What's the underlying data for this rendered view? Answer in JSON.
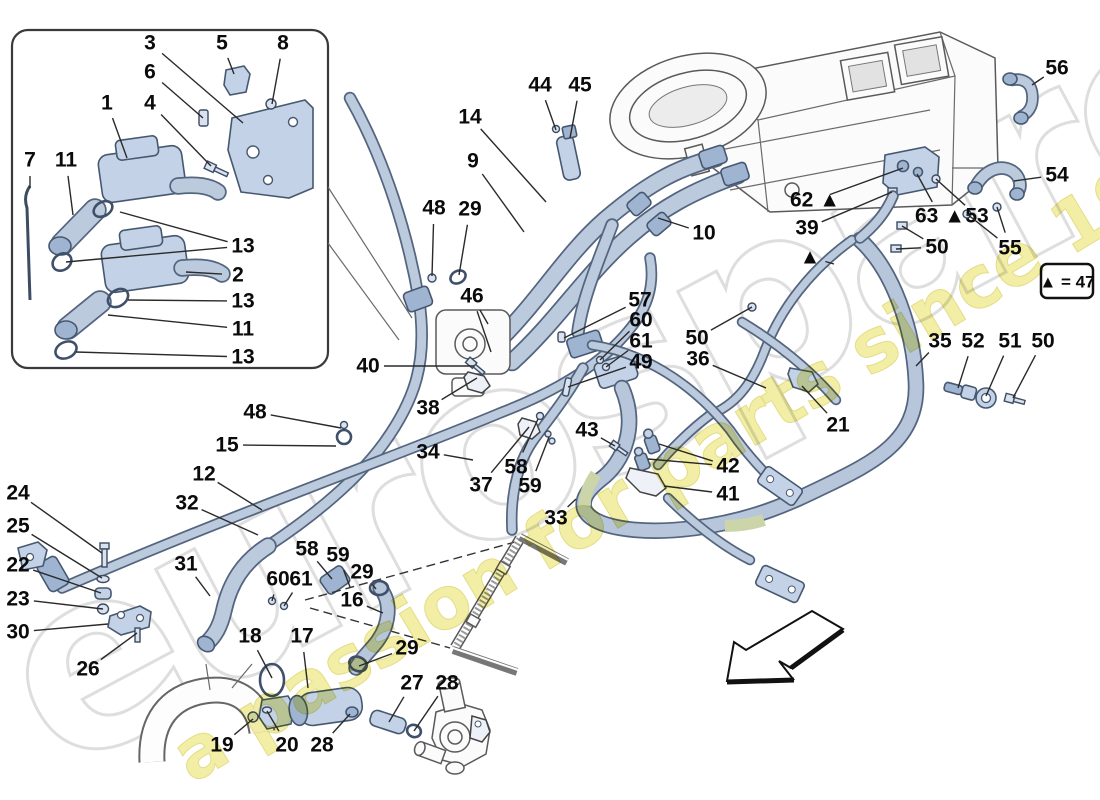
{
  "legend": {
    "text": "▲ = 47"
  },
  "watermark": {
    "primary": "eurospares",
    "secondary": "a passion for parts since 1985"
  },
  "colors": {
    "pipe_fill": "#bccade",
    "pipe_outline": "#54657f",
    "sleeve": "#ccd4a9",
    "watermark_yellow": "#efe98d",
    "watermark_gray": "#dedede",
    "label": "#0b0b0b",
    "line_art": "#5a5a5a"
  },
  "callouts": [
    {
      "label": "3",
      "x": 150,
      "y": 43,
      "targets": [
        [
          243,
          123
        ]
      ]
    },
    {
      "label": "5",
      "x": 222,
      "y": 43,
      "targets": [
        [
          234,
          74
        ]
      ]
    },
    {
      "label": "8",
      "x": 283,
      "y": 43,
      "targets": [
        [
          272,
          104
        ]
      ]
    },
    {
      "label": "6",
      "x": 150,
      "y": 72,
      "targets": [
        [
          203,
          118
        ]
      ]
    },
    {
      "label": "1",
      "x": 107,
      "y": 103,
      "targets": [
        [
          127,
          158
        ]
      ]
    },
    {
      "label": "4",
      "x": 150,
      "y": 103,
      "targets": [
        [
          211,
          166
        ]
      ]
    },
    {
      "label": "7",
      "x": 30,
      "y": 160,
      "targets": [
        [
          30,
          188
        ]
      ]
    },
    {
      "label": "11",
      "x": 66,
      "y": 160,
      "targets": [
        [
          73,
          215
        ]
      ]
    },
    {
      "label": "13",
      "x": 243,
      "y": 246,
      "targets": [
        [
          120,
          212
        ],
        [
          66,
          262
        ]
      ]
    },
    {
      "label": "2",
      "x": 238,
      "y": 275,
      "targets": [
        [
          186,
          272
        ]
      ]
    },
    {
      "label": "13",
      "x": 243,
      "y": 301,
      "targets": [
        [
          128,
          300
        ]
      ]
    },
    {
      "label": "11",
      "x": 243,
      "y": 329,
      "targets": [
        [
          108,
          315
        ]
      ]
    },
    {
      "label": "13",
      "x": 243,
      "y": 357,
      "targets": [
        [
          76,
          352
        ]
      ]
    },
    {
      "label": "44",
      "x": 540,
      "y": 85,
      "targets": [
        [
          556,
          130
        ]
      ]
    },
    {
      "label": "45",
      "x": 580,
      "y": 85,
      "targets": [
        [
          570,
          138
        ]
      ]
    },
    {
      "label": "14",
      "x": 470,
      "y": 117,
      "targets": [
        [
          546,
          202
        ]
      ]
    },
    {
      "label": "9",
      "x": 473,
      "y": 161,
      "targets": [
        [
          524,
          232
        ]
      ]
    },
    {
      "label": "10",
      "x": 704,
      "y": 233,
      "targets": [
        [
          658,
          218
        ]
      ]
    },
    {
      "label": "56",
      "x": 1057,
      "y": 68,
      "targets": [
        [
          1032,
          85
        ]
      ]
    },
    {
      "label": "54",
      "x": 1057,
      "y": 175,
      "targets": [
        [
          1014,
          181
        ]
      ]
    },
    {
      "label": "62 ▲",
      "x": 815,
      "y": 200,
      "targets": [
        [
          903,
          168
        ]
      ]
    },
    {
      "label": "63 ▲",
      "x": 940,
      "y": 216,
      "targets": [
        [
          917,
          174
        ]
      ]
    },
    {
      "label": "53",
      "x": 977,
      "y": 216,
      "targets": [
        [
          936,
          179
        ]
      ]
    },
    {
      "label": "39",
      "x": 807,
      "y": 228,
      "targets": [
        [
          892,
          192
        ]
      ]
    },
    {
      "label": "50",
      "x": 937,
      "y": 247,
      "targets": [
        [
          902,
          226
        ],
        [
          896,
          249
        ]
      ]
    },
    {
      "label": "55",
      "x": 1010,
      "y": 248,
      "targets": [
        [
          967,
          214
        ],
        [
          997,
          207
        ]
      ]
    },
    {
      "label": "▲",
      "x": 810,
      "y": 257,
      "targets": [
        [
          834,
          264
        ]
      ]
    },
    {
      "label": "48",
      "x": 434,
      "y": 208,
      "targets": [
        [
          432,
          276
        ]
      ]
    },
    {
      "label": "29",
      "x": 470,
      "y": 209,
      "targets": [
        [
          459,
          275
        ]
      ]
    },
    {
      "label": "46",
      "x": 472,
      "y": 296,
      "targets": [
        [
          488,
          324
        ],
        [
          491,
          352
        ]
      ]
    },
    {
      "label": "57",
      "x": 640,
      "y": 300,
      "targets": [
        [
          564,
          338
        ]
      ]
    },
    {
      "label": "60",
      "x": 641,
      "y": 320,
      "targets": [
        [
          600,
          360
        ]
      ]
    },
    {
      "label": "61",
      "x": 641,
      "y": 341,
      "targets": [
        [
          606,
          367
        ]
      ]
    },
    {
      "label": "49",
      "x": 641,
      "y": 362,
      "targets": [
        [
          568,
          387
        ]
      ]
    },
    {
      "label": "40",
      "x": 368,
      "y": 366,
      "targets": [
        [
          474,
          366
        ]
      ]
    },
    {
      "label": "38",
      "x": 428,
      "y": 408,
      "targets": [
        [
          477,
          378
        ]
      ]
    },
    {
      "label": "50",
      "x": 697,
      "y": 338,
      "targets": [
        [
          752,
          307
        ]
      ]
    },
    {
      "label": "36",
      "x": 698,
      "y": 359,
      "targets": [
        [
          766,
          388
        ]
      ]
    },
    {
      "label": "35",
      "x": 940,
      "y": 341,
      "targets": [
        [
          916,
          366
        ]
      ]
    },
    {
      "label": "52",
      "x": 973,
      "y": 341,
      "targets": [
        [
          958,
          388
        ]
      ]
    },
    {
      "label": "51",
      "x": 1010,
      "y": 341,
      "targets": [
        [
          986,
          396
        ]
      ]
    },
    {
      "label": "50",
      "x": 1043,
      "y": 341,
      "targets": [
        [
          1013,
          398
        ]
      ]
    },
    {
      "label": "21",
      "x": 838,
      "y": 425,
      "targets": [
        [
          802,
          386
        ]
      ]
    },
    {
      "label": "43",
      "x": 587,
      "y": 430,
      "targets": [
        [
          615,
          446
        ]
      ]
    },
    {
      "label": "42",
      "x": 728,
      "y": 466,
      "targets": [
        [
          659,
          444
        ],
        [
          648,
          459
        ]
      ]
    },
    {
      "label": "41",
      "x": 728,
      "y": 494,
      "targets": [
        [
          664,
          486
        ]
      ]
    },
    {
      "label": "48",
      "x": 255,
      "y": 412,
      "targets": [
        [
          341,
          428
        ]
      ]
    },
    {
      "label": "15",
      "x": 227,
      "y": 445,
      "targets": [
        [
          336,
          446
        ]
      ]
    },
    {
      "label": "34",
      "x": 428,
      "y": 452,
      "targets": [
        [
          473,
          460
        ]
      ]
    },
    {
      "label": "12",
      "x": 204,
      "y": 474,
      "targets": [
        [
          262,
          510
        ]
      ]
    },
    {
      "label": "32",
      "x": 187,
      "y": 503,
      "targets": [
        [
          258,
          535
        ]
      ]
    },
    {
      "label": "31",
      "x": 186,
      "y": 564,
      "targets": [
        [
          210,
          596
        ]
      ]
    },
    {
      "label": "58",
      "x": 516,
      "y": 467,
      "targets": [
        [
          538,
          419
        ]
      ]
    },
    {
      "label": "37",
      "x": 481,
      "y": 485,
      "targets": [
        [
          529,
          427
        ]
      ]
    },
    {
      "label": "59",
      "x": 530,
      "y": 486,
      "targets": [
        [
          549,
          437
        ]
      ]
    },
    {
      "label": "33",
      "x": 556,
      "y": 518,
      "targets": [
        [
          576,
          499
        ]
      ]
    },
    {
      "label": "58",
      "x": 307,
      "y": 549,
      "targets": [
        [
          332,
          579
        ]
      ]
    },
    {
      "label": "59",
      "x": 338,
      "y": 555,
      "targets": [
        [
          350,
          587
        ]
      ]
    },
    {
      "label": "60",
      "x": 278,
      "y": 579,
      "targets": [
        [
          272,
          601
        ]
      ]
    },
    {
      "label": "61",
      "x": 301,
      "y": 579,
      "targets": [
        [
          284,
          606
        ]
      ]
    },
    {
      "label": "29",
      "x": 362,
      "y": 572,
      "targets": [
        [
          376,
          589
        ]
      ]
    },
    {
      "label": "16",
      "x": 352,
      "y": 600,
      "targets": [
        [
          383,
          613
        ]
      ]
    },
    {
      "label": "18",
      "x": 250,
      "y": 636,
      "targets": [
        [
          272,
          678
        ]
      ]
    },
    {
      "label": "17",
      "x": 302,
      "y": 636,
      "targets": [
        [
          308,
          688
        ]
      ]
    },
    {
      "label": "29",
      "x": 407,
      "y": 648,
      "targets": [
        [
          359,
          666
        ]
      ]
    },
    {
      "label": "27",
      "x": 412,
      "y": 683,
      "targets": [
        [
          389,
          722
        ]
      ]
    },
    {
      "label": "28",
      "x": 447,
      "y": 683,
      "targets": [
        [
          414,
          731
        ]
      ]
    },
    {
      "label": "19",
      "x": 222,
      "y": 745,
      "targets": [
        [
          253,
          719
        ]
      ]
    },
    {
      "label": "20",
      "x": 287,
      "y": 745,
      "targets": [
        [
          267,
          711
        ]
      ]
    },
    {
      "label": "28",
      "x": 322,
      "y": 745,
      "targets": [
        [
          350,
          714
        ]
      ]
    },
    {
      "label": "24",
      "x": 18,
      "y": 493,
      "targets": [
        [
          102,
          553
        ]
      ]
    },
    {
      "label": "25",
      "x": 18,
      "y": 526,
      "targets": [
        [
          102,
          578
        ]
      ]
    },
    {
      "label": "22",
      "x": 18,
      "y": 565,
      "targets": [
        [
          101,
          593
        ]
      ]
    },
    {
      "label": "23",
      "x": 18,
      "y": 599,
      "targets": [
        [
          103,
          609
        ]
      ]
    },
    {
      "label": "30",
      "x": 18,
      "y": 632,
      "targets": [
        [
          108,
          624
        ]
      ]
    },
    {
      "label": "26",
      "x": 88,
      "y": 669,
      "targets": [
        [
          137,
          633
        ]
      ]
    }
  ]
}
